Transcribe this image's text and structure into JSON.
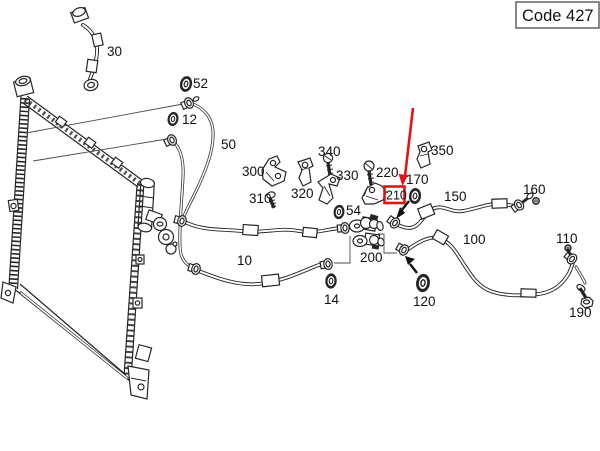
{
  "window": {
    "code_badge": "Code 427"
  },
  "diagram": {
    "highlight": {
      "part": "210"
    },
    "colors": {
      "background": "#ffffff",
      "line_art": "#262626",
      "highlight_red": "#e41414",
      "code_box_border": "#555555"
    },
    "parts": {
      "10": "10",
      "12": "12",
      "14": "14",
      "30": "30",
      "50": "50",
      "52": "52",
      "54": "54",
      "100": "100",
      "110": "110",
      "120": "120",
      "150": "150",
      "160": "160",
      "170": "170",
      "190": "190",
      "200": "200",
      "210": "210",
      "220": "220",
      "300": "300",
      "310": "310",
      "320": "320",
      "330": "330",
      "340": "340",
      "350": "350"
    }
  }
}
